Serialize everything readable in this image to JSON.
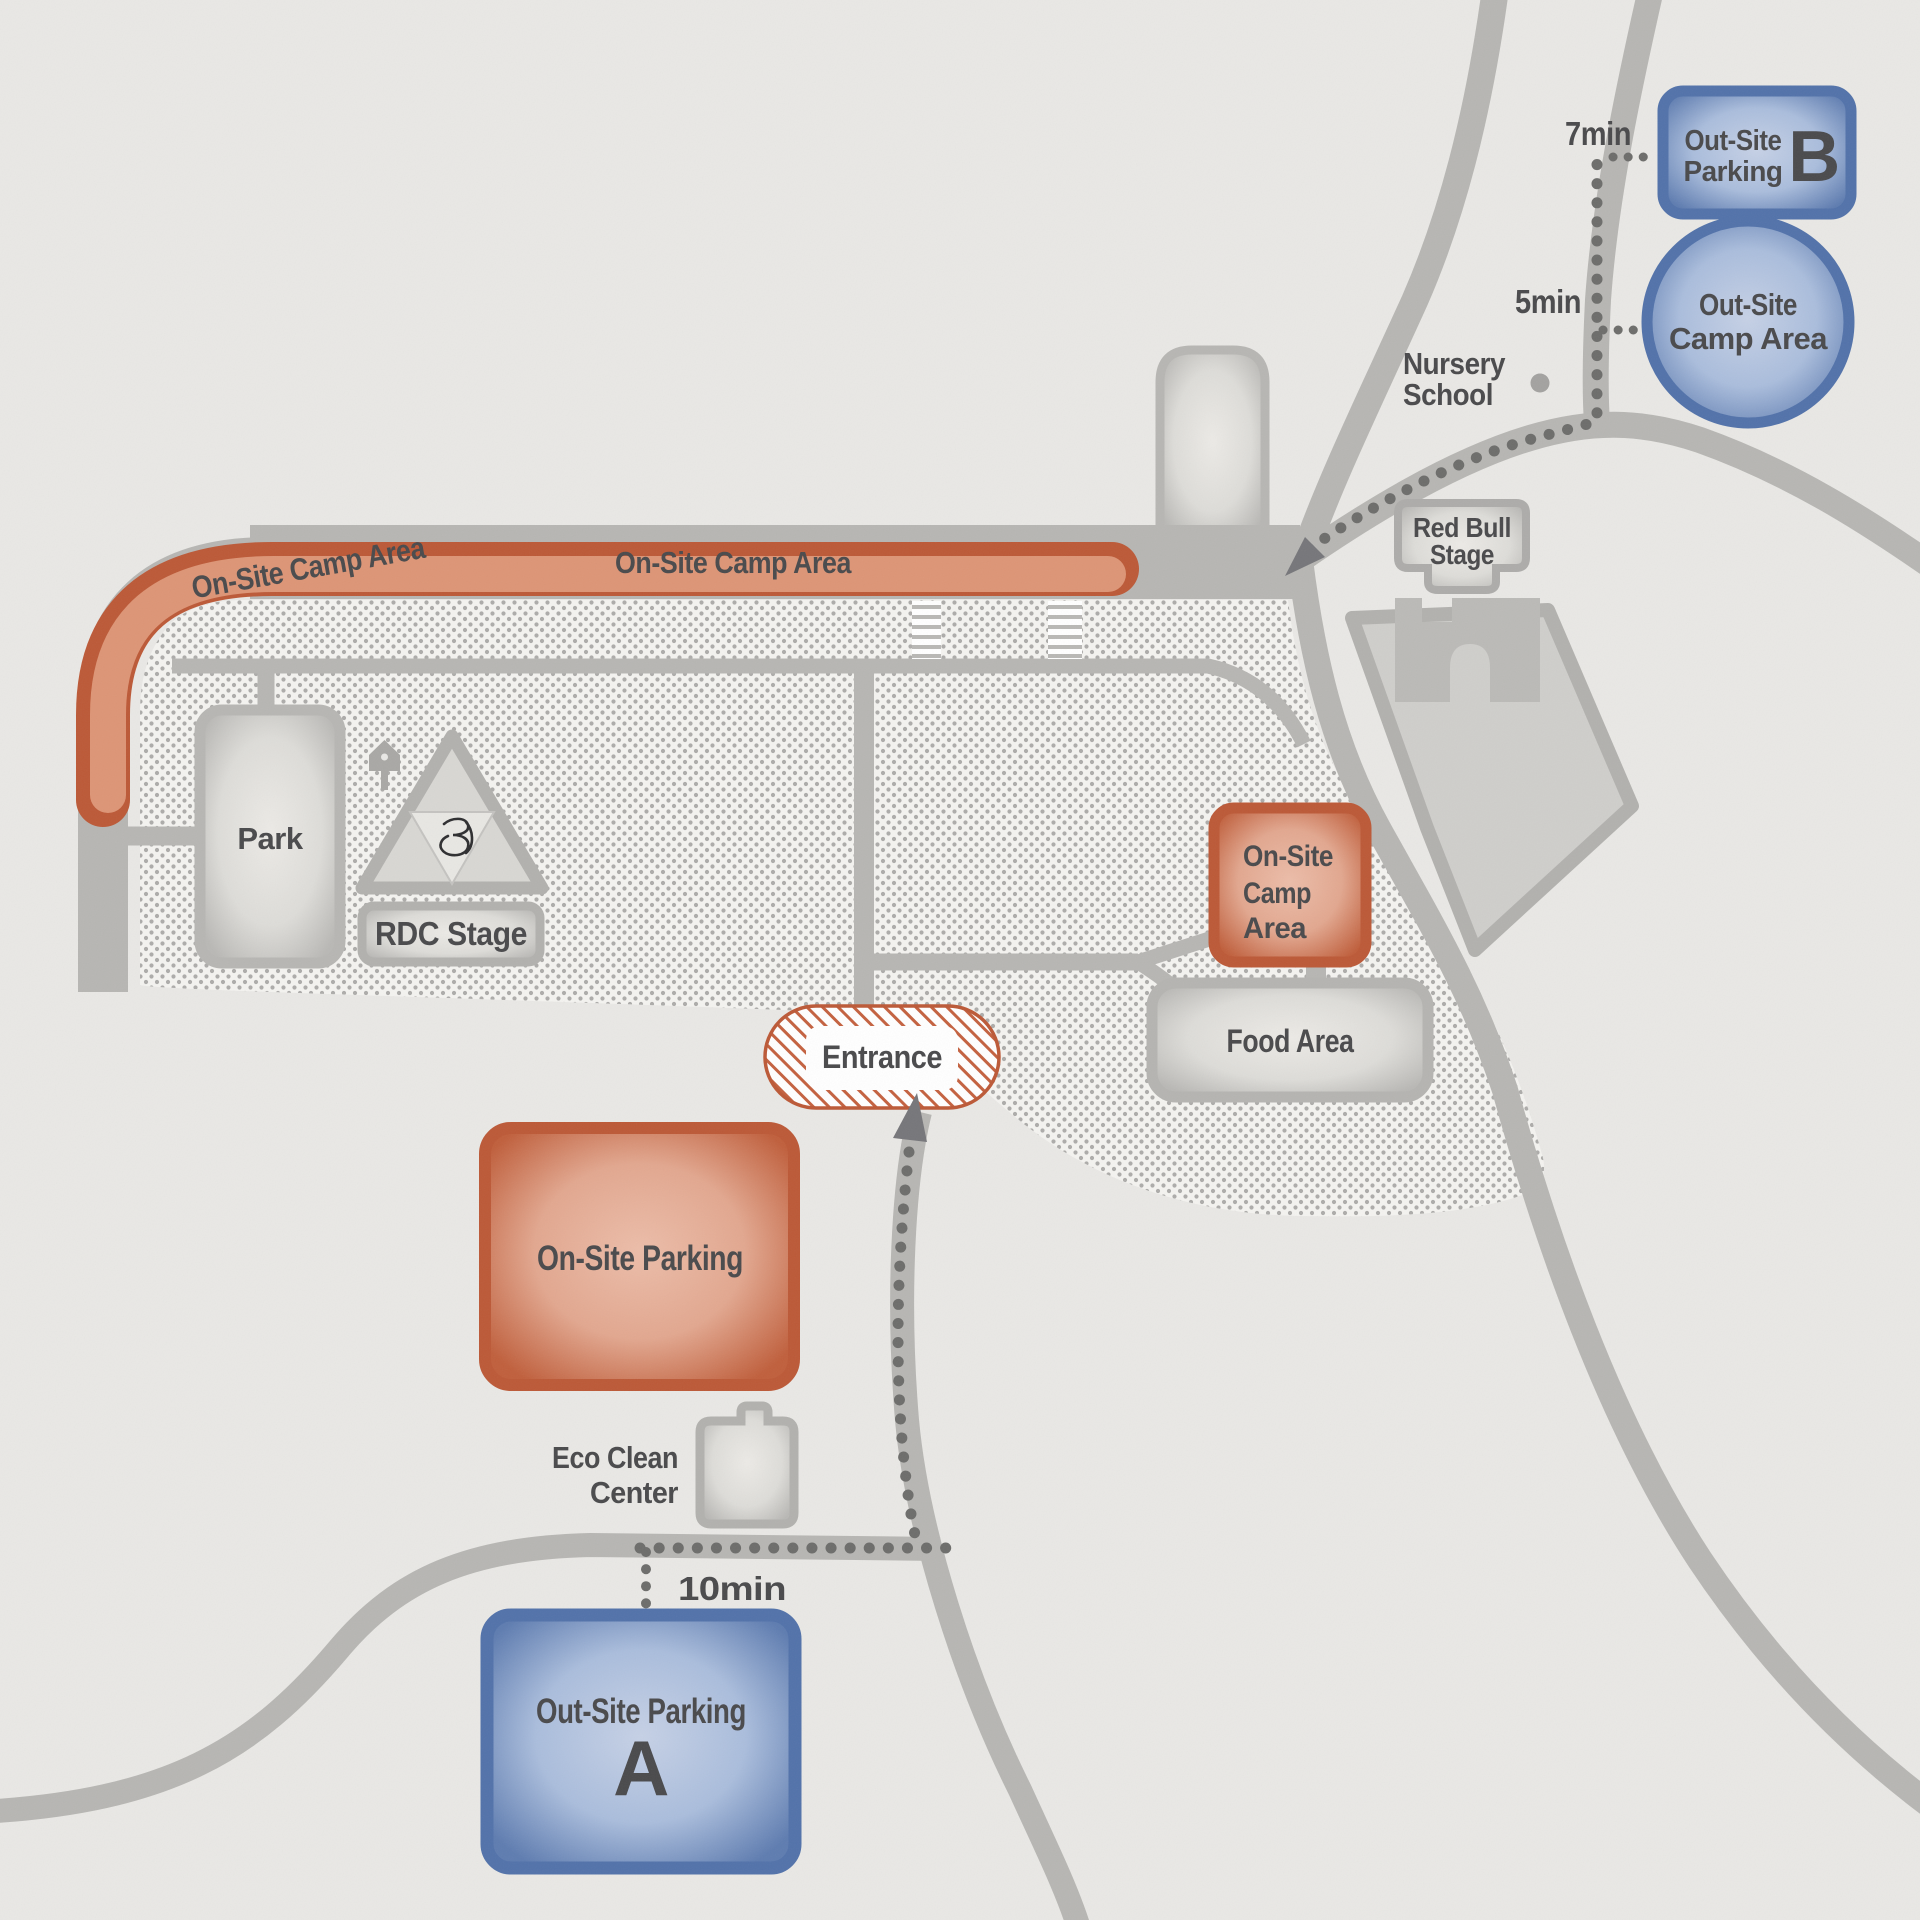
{
  "map": {
    "band": {
      "label_left": "On-Site Camp Area",
      "label_right": "On-Site Camp Area"
    },
    "park": {
      "label": "Park"
    },
    "rdc_stage": {
      "label": "RDC Stage"
    },
    "red_bull_stage": {
      "line1": "Red Bull",
      "line2": "Stage"
    },
    "nursery_school": {
      "line1": "Nursery",
      "line2": "School"
    },
    "entrance": {
      "label": "Entrance"
    },
    "food_area": {
      "label": "Food Area"
    },
    "on_site_camp_square": {
      "line1": "On-Site",
      "line2": "Camp",
      "line3": "Area"
    },
    "on_site_parking": {
      "label": "On-Site Parking"
    },
    "eco_clean_center": {
      "line1": "Eco Clean",
      "line2": "Center"
    },
    "out_site_parking_a": {
      "label": "Out-Site Parking",
      "letter": "A",
      "walk_time": "10min"
    },
    "out_site_parking_b": {
      "line1": "Out-Site",
      "line2": "Parking",
      "letter": "B",
      "walk_time": "7min"
    },
    "out_site_camp_area": {
      "line1": "Out-Site",
      "line2": "Camp Area",
      "walk_time": "5min"
    }
  },
  "colors": {
    "on_site_accent": "#bc5937",
    "out_site_accent": "#5272aa",
    "road": "#b7b6b3",
    "label_text": "#4a4a4c",
    "path_dots": "#6d6d6b"
  }
}
